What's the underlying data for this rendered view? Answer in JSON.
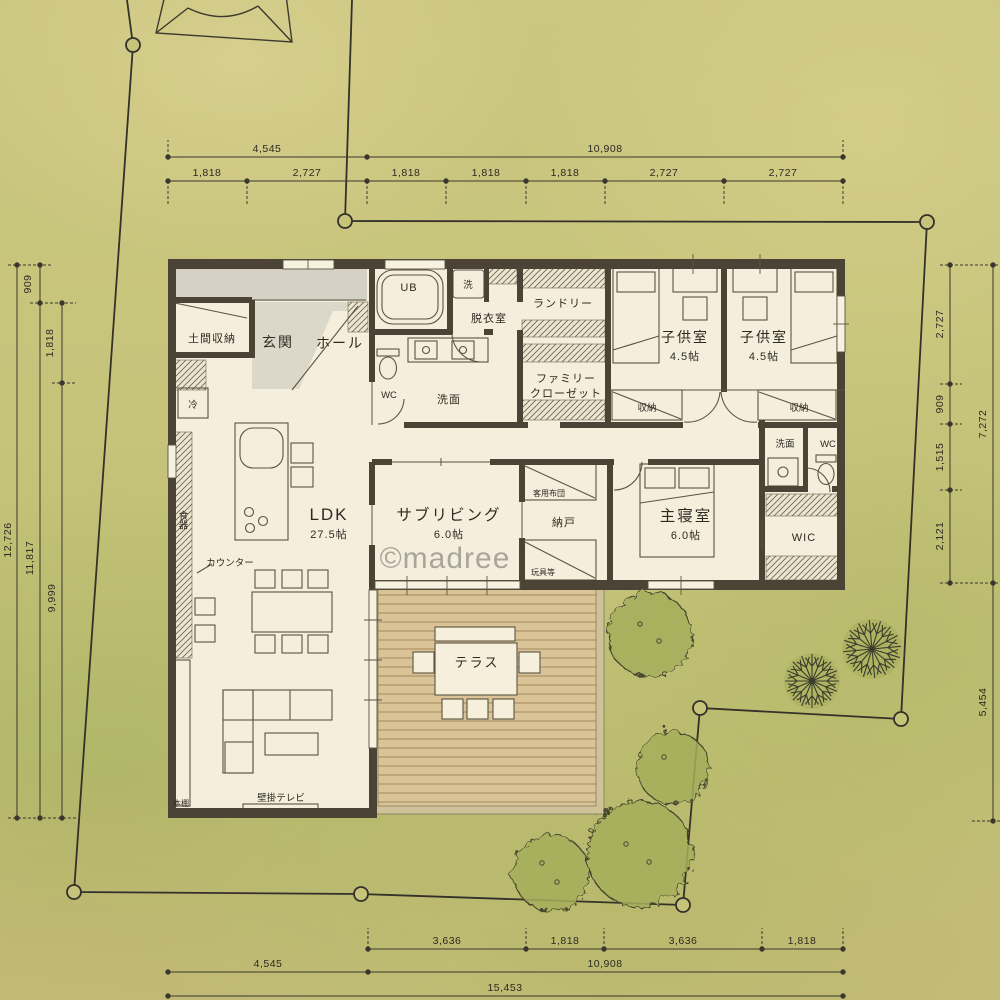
{
  "title": "site and floor plan drawing",
  "watermark": "©madree",
  "colors": {
    "background_olive": "#c6c47b",
    "wall": "#4a4336",
    "floor": "#f5eedd",
    "porch_gray": "#d5d1c4",
    "deck_wood": "#d9c397",
    "tree_green": "#a7ae5e",
    "line": "#3a382e"
  },
  "dims": {
    "top": {
      "total_left": "4,545",
      "total_right": "10,908",
      "seg1": "1,818",
      "seg2": "2,727",
      "seg3": "1,818",
      "seg4": "1,818",
      "seg5": "1,818",
      "seg6": "2,727",
      "seg7": "2,727"
    },
    "bottom": {
      "seg1": "3,636",
      "seg2": "1,818",
      "seg3": "3,636",
      "seg4": "1,818",
      "total_left": "4,545",
      "total_right": "10,908",
      "total": "15,453"
    },
    "left": {
      "seg909": "909",
      "seg1818": "1,818",
      "total1": "12,726",
      "total2": "11,817",
      "total3": "9,999"
    },
    "right": {
      "seg1": "2,727",
      "seg2": "909",
      "seg3": "1,515",
      "seg4": "2,121",
      "total1": "7,272",
      "total2": "5,454"
    }
  },
  "rooms": {
    "doma": "土間収納",
    "genkan": "玄関",
    "hall": "ホール",
    "fridge": "冷",
    "ub": "UB",
    "washer": "洗",
    "datsuishitsu": "脱衣室",
    "wc1": "WC",
    "senmen1": "洗面",
    "laundry": "ランドリー",
    "famiclo1": "ファミリー",
    "famiclo2": "クローゼット",
    "kids1": "子供室",
    "kids1_size": "4.5帖",
    "kids2": "子供室",
    "kids2_size": "4.5帖",
    "storage1": "収納",
    "storage2": "収納",
    "ldk": "LDK",
    "ldk_size": "27.5帖",
    "subliving": "サブリビング",
    "subliving_size": "6.0帖",
    "nando": "納戸",
    "guest_futon": "客用布団",
    "toys": "玩具等",
    "master": "主寝室",
    "master_size": "6.0帖",
    "wic": "WIC",
    "senmen2": "洗面",
    "wc2": "WC",
    "counter": "カウンター",
    "dishes": "食器",
    "bookshelf": "本棚",
    "wall_tv": "壁掛テレビ",
    "terrace": "テラス"
  }
}
